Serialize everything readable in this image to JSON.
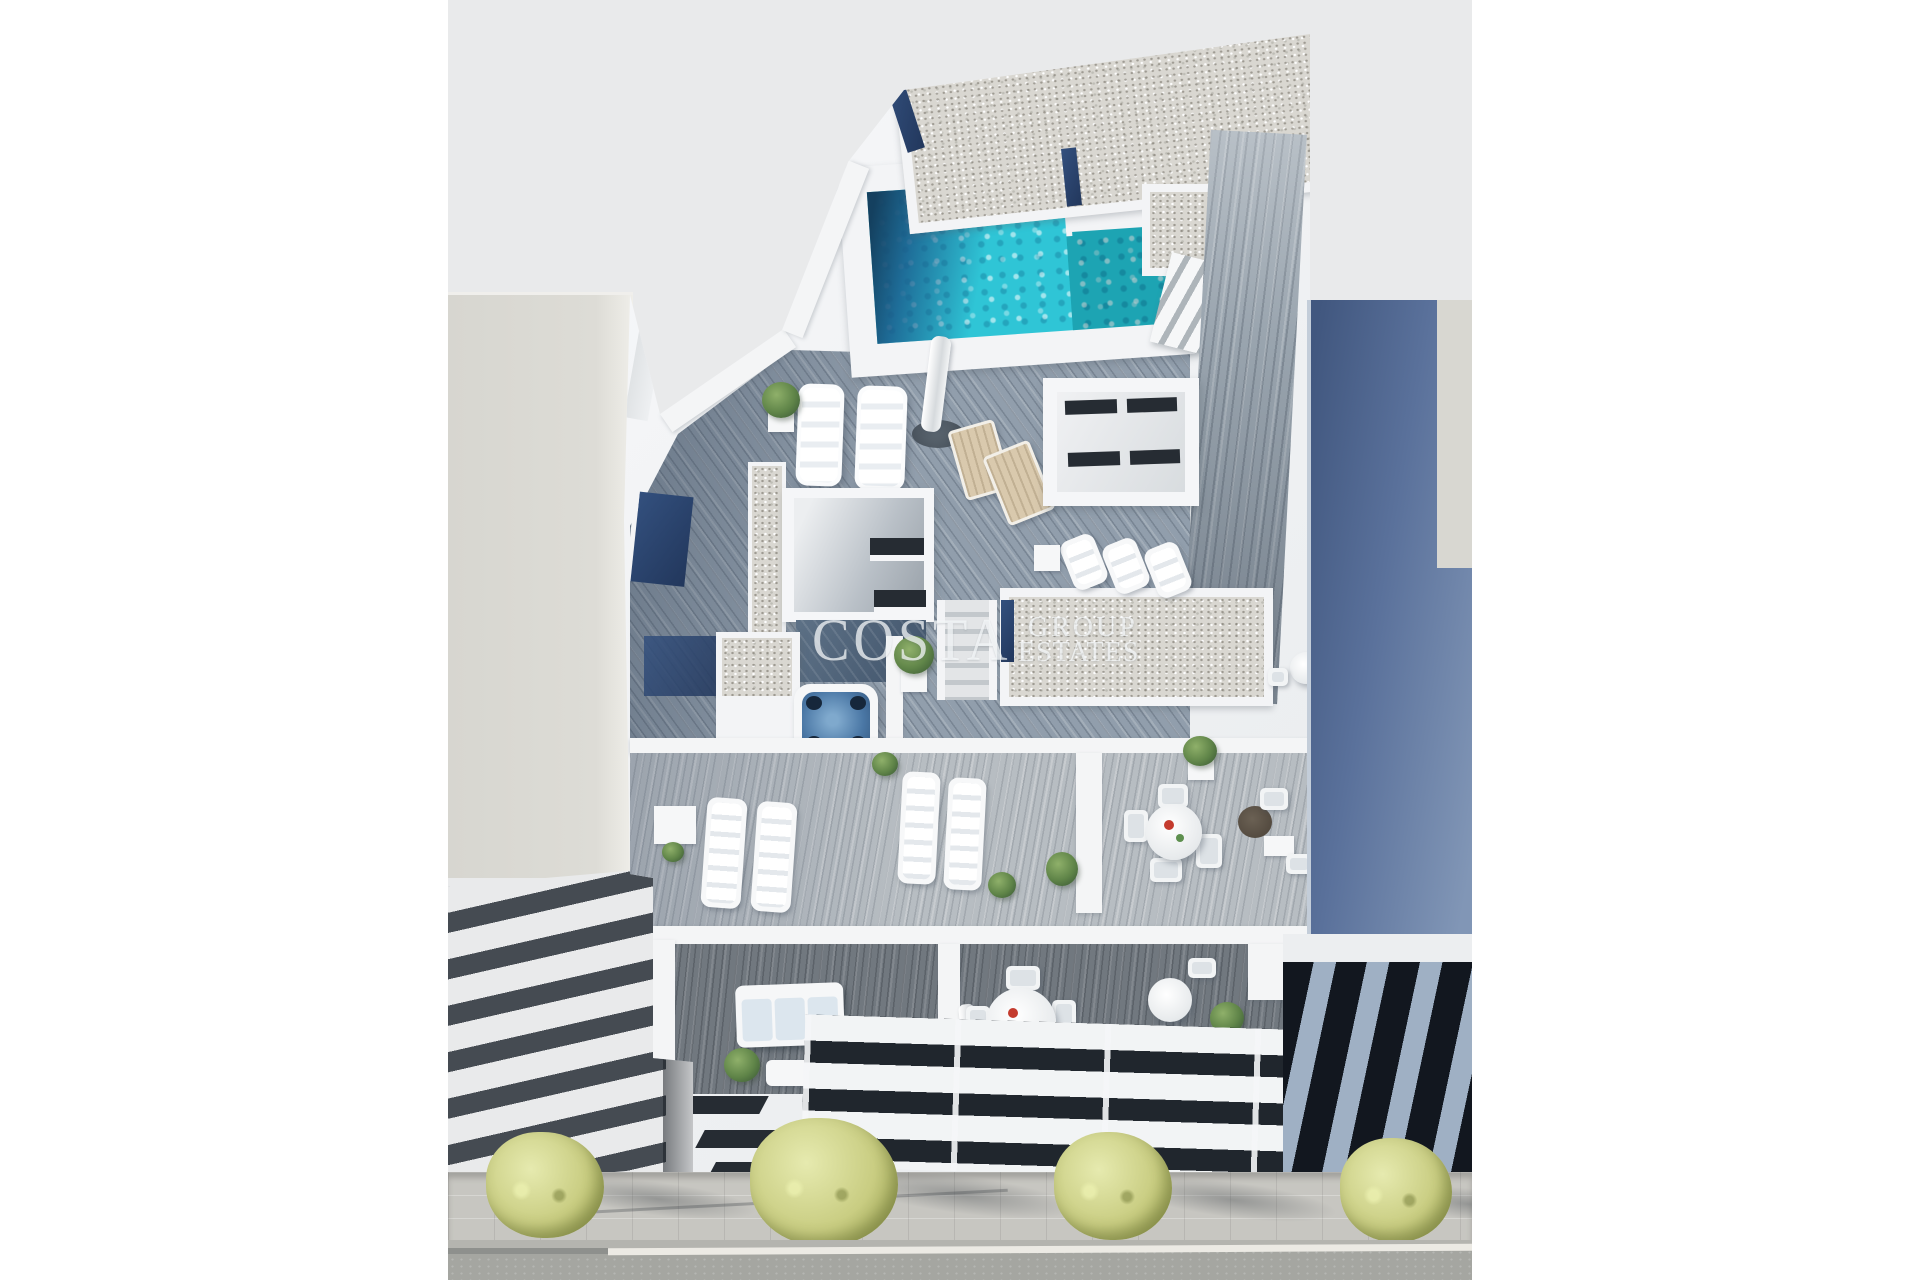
{
  "meta": {
    "type": "3d-architectural-rendering",
    "view": "aerial-top-down",
    "subject": "new-build apartment building with rooftop pool, jacuzzi and furnished terraces on a tree-lined street"
  },
  "watermark": {
    "brand": "COSTA",
    "brand_sub1": "GROUP",
    "brand_sub2": "ESTATES",
    "style": "translucent white serif lettering"
  },
  "palette": {
    "page_margin": "#ffffff",
    "render_background": "#e9eaeb",
    "white_walls": "#f3f4f6",
    "pool_turquoise": "#2fc5d6",
    "pool_shadow_blue": "#1b5d8d",
    "pool_dark_corner": "#14405f",
    "navy_planter_strip": "#2c4470",
    "gravel_roof": "#d9d7d1",
    "wood_deck_blue_grey": "#919eac",
    "wood_deck_light": "#b7bdc2",
    "wood_deck_dark": "#71787f",
    "jacuzzi_water": "#3f6b9a",
    "neighbor_left_block": "#dbdad4",
    "neighbor_left_louver_dark": "#454b52",
    "neighbor_right_blue_wall": "#52688f",
    "neighbor_right_louver_dark": "#12171f",
    "neighbor_right_louver_light": "#9fb0c4",
    "sidewalk": "#c7c6c1",
    "road": "#a5a6a1",
    "lane_line": "#eceae4",
    "tree_foliage": "#c9cd82",
    "white_furniture": "#f6f7f8",
    "tan_deck_chair": "#d9c9ad"
  },
  "scene": {
    "main_building": {
      "features": [
        "rooftop-pool",
        "pool-stairs",
        "gravel-roof-sections",
        "navy-solar-strips",
        "wood-deck-terraces",
        "jacuzzi",
        "skylight-boxes",
        "plush-sun-loungers",
        "closed-parasol",
        "tan-deck-chairs",
        "flat-sun-loungers",
        "terrace-dining-set",
        "terrace-bistro-set",
        "balcony-sofa-set",
        "balcony-dining-set",
        "balcony-bistro-set",
        "potted-plants",
        "slit-window-facade",
        "band-window-facade"
      ]
    },
    "neighbor_left": {
      "features": [
        "flat-roof-block",
        "white-louvered-facade"
      ]
    },
    "neighbor_right": {
      "features": [
        "blue-side-wall",
        "dark-louvered-facade"
      ]
    },
    "street": {
      "tree_count": 4,
      "features": [
        "paved-sidewalk",
        "tree-shadows",
        "curb",
        "white-lane-line",
        "asphalt-road"
      ]
    }
  }
}
